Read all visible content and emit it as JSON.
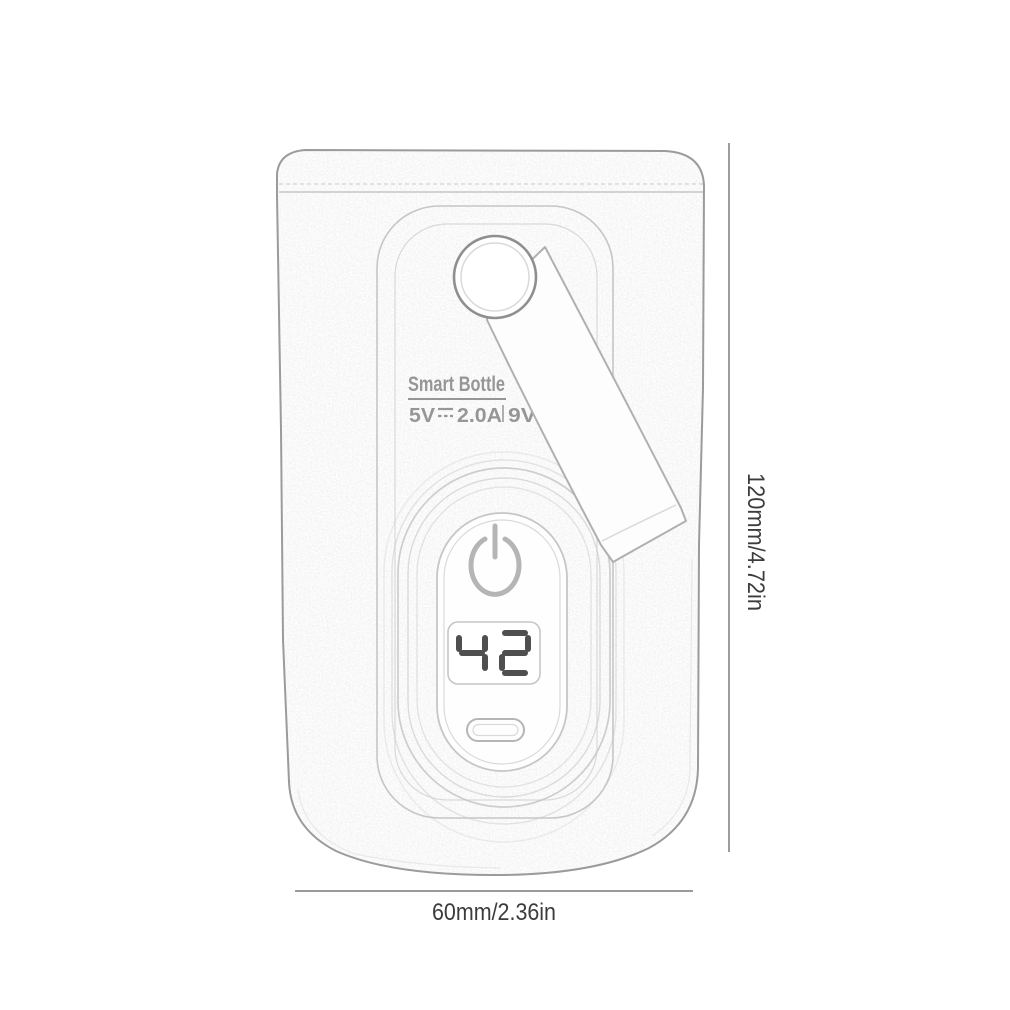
{
  "page": {
    "background": "#ffffff"
  },
  "device": {
    "label": {
      "title": "Smart Bottle",
      "voltage": "5V",
      "current": "2.0A",
      "secondary_voltage": "9V"
    },
    "display_value": "42",
    "icons": {
      "power": "power-icon",
      "charge_port": "usb-c-port-icon",
      "hang_hole": "hang-hole"
    }
  },
  "dimensions": {
    "height_label": "120mm/4.72in",
    "width_label": "60mm/2.36in"
  },
  "colors": {
    "line": "#9b9b9b",
    "line_light": "#c6c6c6",
    "line_faint": "#d9d9d9",
    "icon_gray": "#b5b5b5",
    "grommet": "#8f8f8f",
    "strap_line": "#b0b0b0",
    "text_gray": "#969696",
    "digit": "#4f4f4f",
    "dimension_line": "#8c8c8c",
    "dimension_text": "#3c3c3c"
  }
}
